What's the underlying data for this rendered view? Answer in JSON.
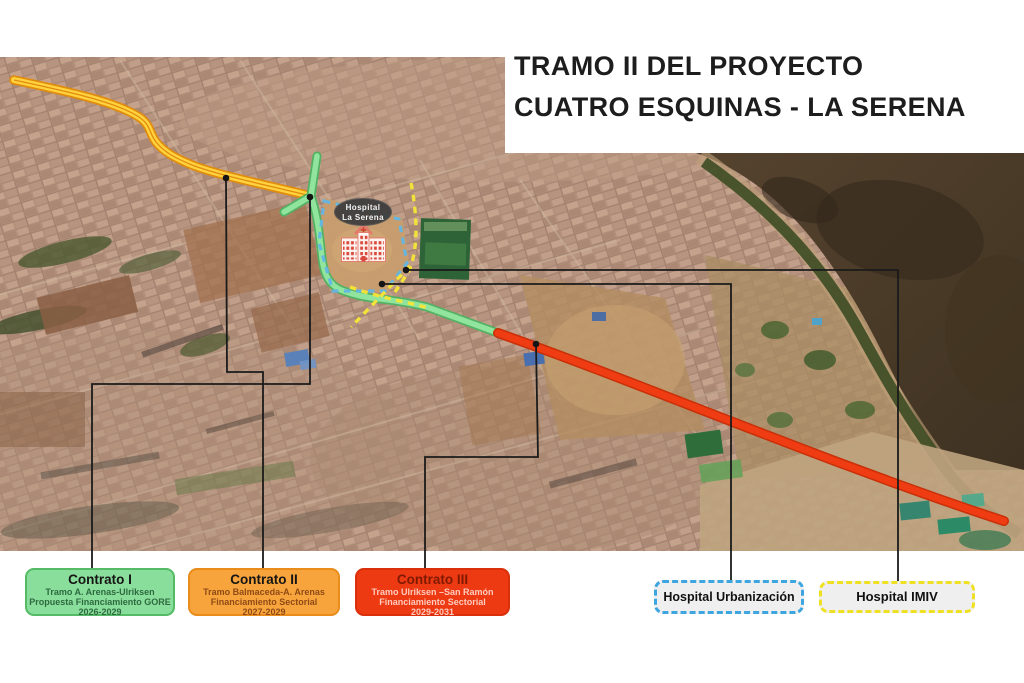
{
  "title": {
    "line1": "TRAMO II DEL PROYECTO",
    "line2": "CUATRO ESQUINAS - LA SERENA"
  },
  "map": {
    "hospital_label": {
      "line1": "Hospital",
      "line2": "La Serena"
    }
  },
  "colors": {
    "road_contract1_green": "#90e49e",
    "road_contract2_yellow": "#ffd23e",
    "road_contract3_red": "#ef3c12",
    "hospital_urbanizacion_dash": "#62b5e5",
    "hospital_imiv_dash": "#f6e737",
    "connector_line": "#1b1b1b"
  },
  "legend": {
    "contracts": [
      {
        "title": "Contrato I",
        "line1": "Tramo A. Arenas-Ulriksen",
        "line2": "Propuesta Financiamiento GORE",
        "line3": "2026-2029",
        "fill": "#8ade9b",
        "border": "#55bb66"
      },
      {
        "title": "Contrato II",
        "line1": "Tramo Balmaceda-A. Arenas",
        "line2": "Financiamiento Sectorial",
        "line3": "2027-2029",
        "fill": "#f7a43c",
        "border": "#ea8c1c"
      },
      {
        "title": "Contrato III",
        "line1": "Tramo Ulriksen –San Ramón",
        "line2": "Financiamiento Sectorial",
        "line3": "2029-2031",
        "fill": "#ee3a12",
        "border": "#d92f0a"
      }
    ],
    "hospitals": [
      {
        "label": "Hospital Urbanización",
        "border": "#3da5e0"
      },
      {
        "label": "Hospital IMIV",
        "border": "#f0e023"
      }
    ]
  }
}
